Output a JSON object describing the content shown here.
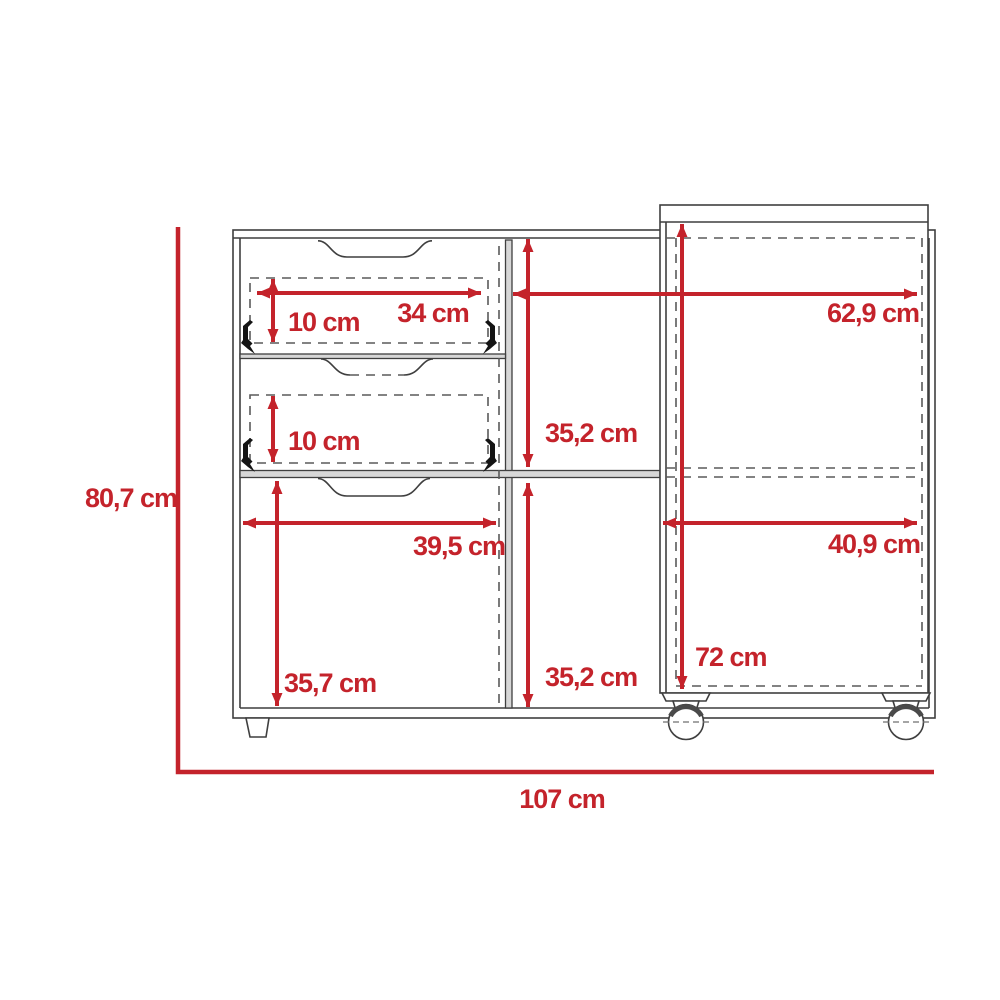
{
  "diagram": {
    "title": "furniture-dimension-drawing",
    "units": "cm",
    "accent_color": "#C4232B",
    "line_color": "#3F3F3F",
    "labels": {
      "total_height": "80,7 cm",
      "total_width": "107 cm",
      "drawer_top_width": "34 cm",
      "drawer_top_height": "10 cm",
      "drawer_mid_height": "10 cm",
      "cart_top_width": "62,9 cm",
      "shelf_upper_height": "35,2 cm",
      "shelf_lower_height": "35,2 cm",
      "door_width": "39,5 cm",
      "door_height": "35,7 cm",
      "cart_lower_width": "40,9 cm",
      "cart_height": "72 cm"
    }
  }
}
